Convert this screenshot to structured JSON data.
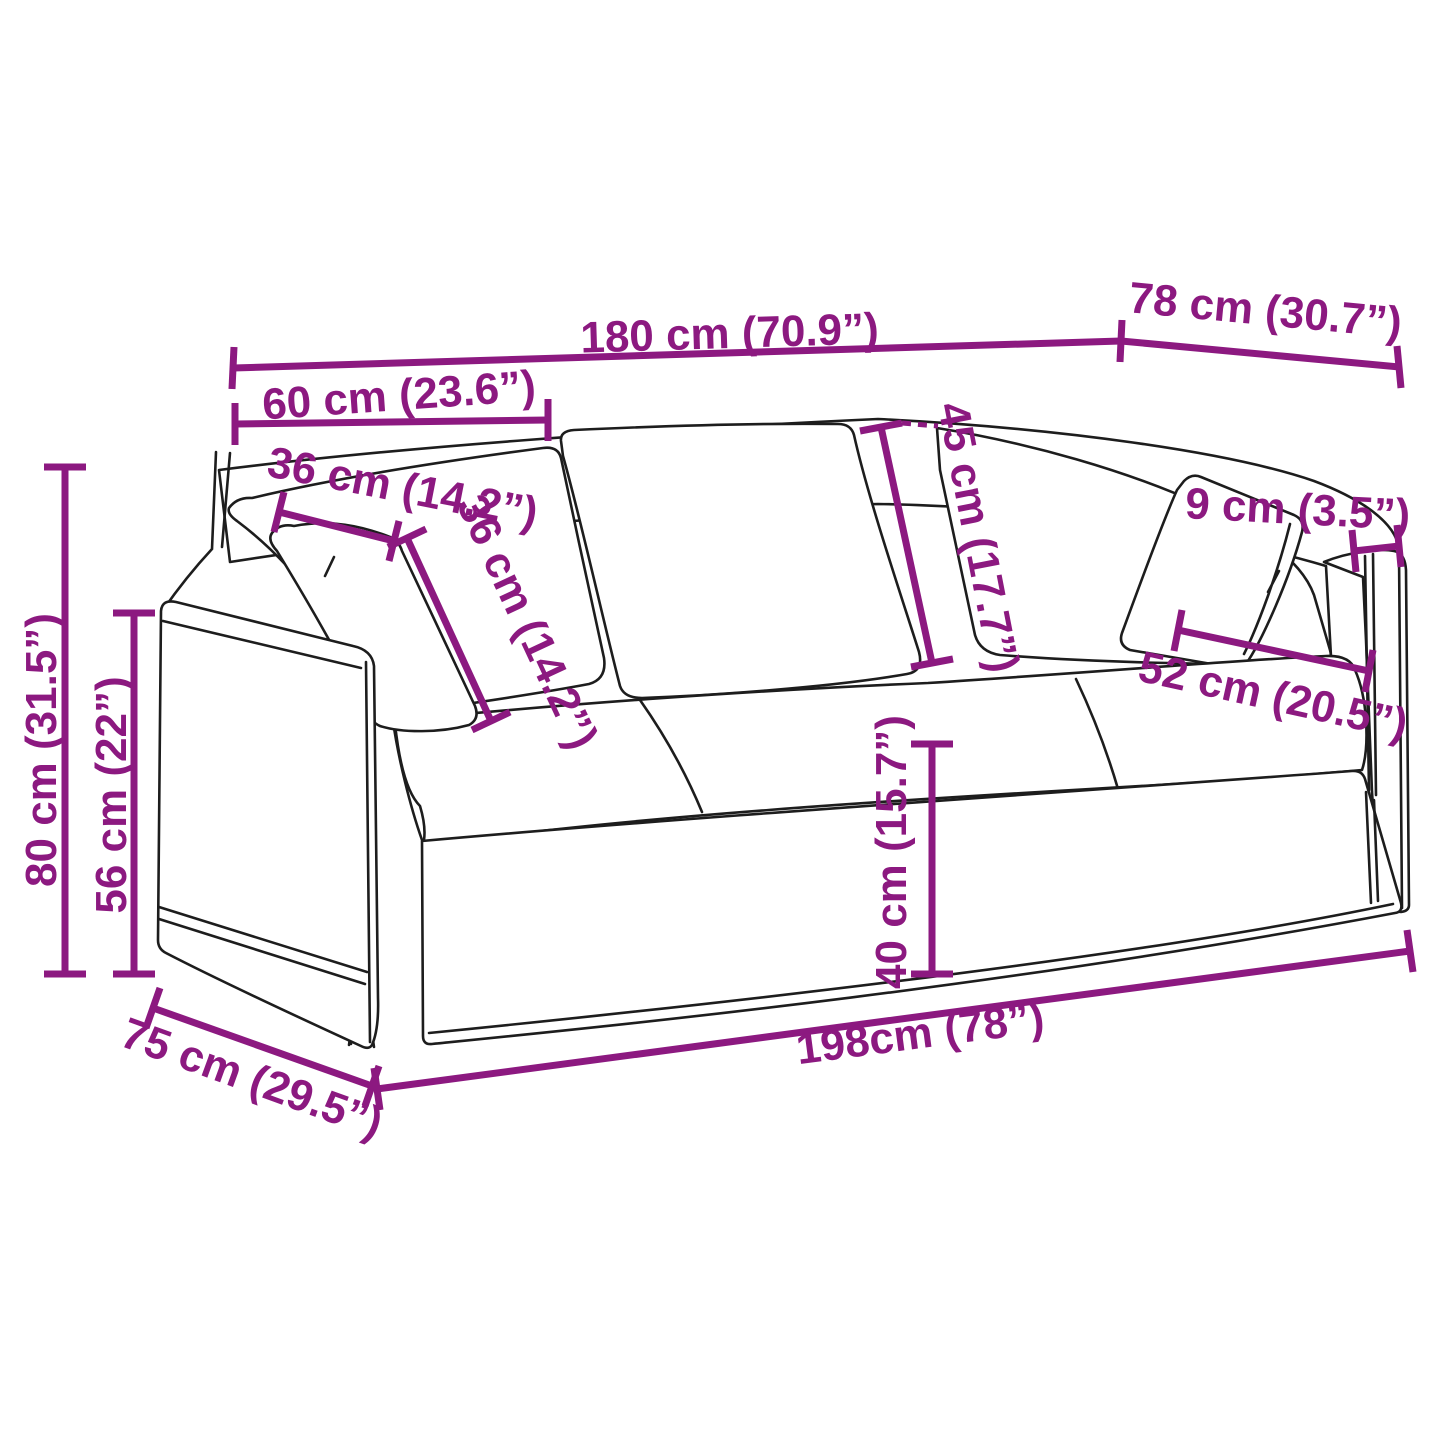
{
  "diagram": {
    "title": "3-seater sofa dimension diagram",
    "accent_color": "#8C1980",
    "line_color": "#1D1D1D",
    "background_color": "#FFFFFF",
    "dimensions": [
      {
        "id": "back-width",
        "label": "180 cm (70.9”)"
      },
      {
        "id": "top-depth",
        "label": "78 cm (30.7”)"
      },
      {
        "id": "backrest-section-width",
        "label": "60 cm (23.6”)"
      },
      {
        "id": "pillow-width",
        "label": "36 cm (14.2”)"
      },
      {
        "id": "pillow-height",
        "label": "36 cm (14.2”)"
      },
      {
        "id": "backrest-height",
        "label": "45 cm (17.7”)"
      },
      {
        "id": "armrest-width",
        "label": "9 cm (3.5”)"
      },
      {
        "id": "seat-depth",
        "label": "52 cm (20.5”)"
      },
      {
        "id": "total-height",
        "label": "80 cm (31.5”)"
      },
      {
        "id": "armrest-height",
        "label": "56 cm (22”)"
      },
      {
        "id": "seat-height",
        "label": "40 cm (15.7”)"
      },
      {
        "id": "side-depth",
        "label": "75 cm (29.5”)"
      },
      {
        "id": "total-width",
        "label": "198cm (78”)"
      }
    ]
  }
}
